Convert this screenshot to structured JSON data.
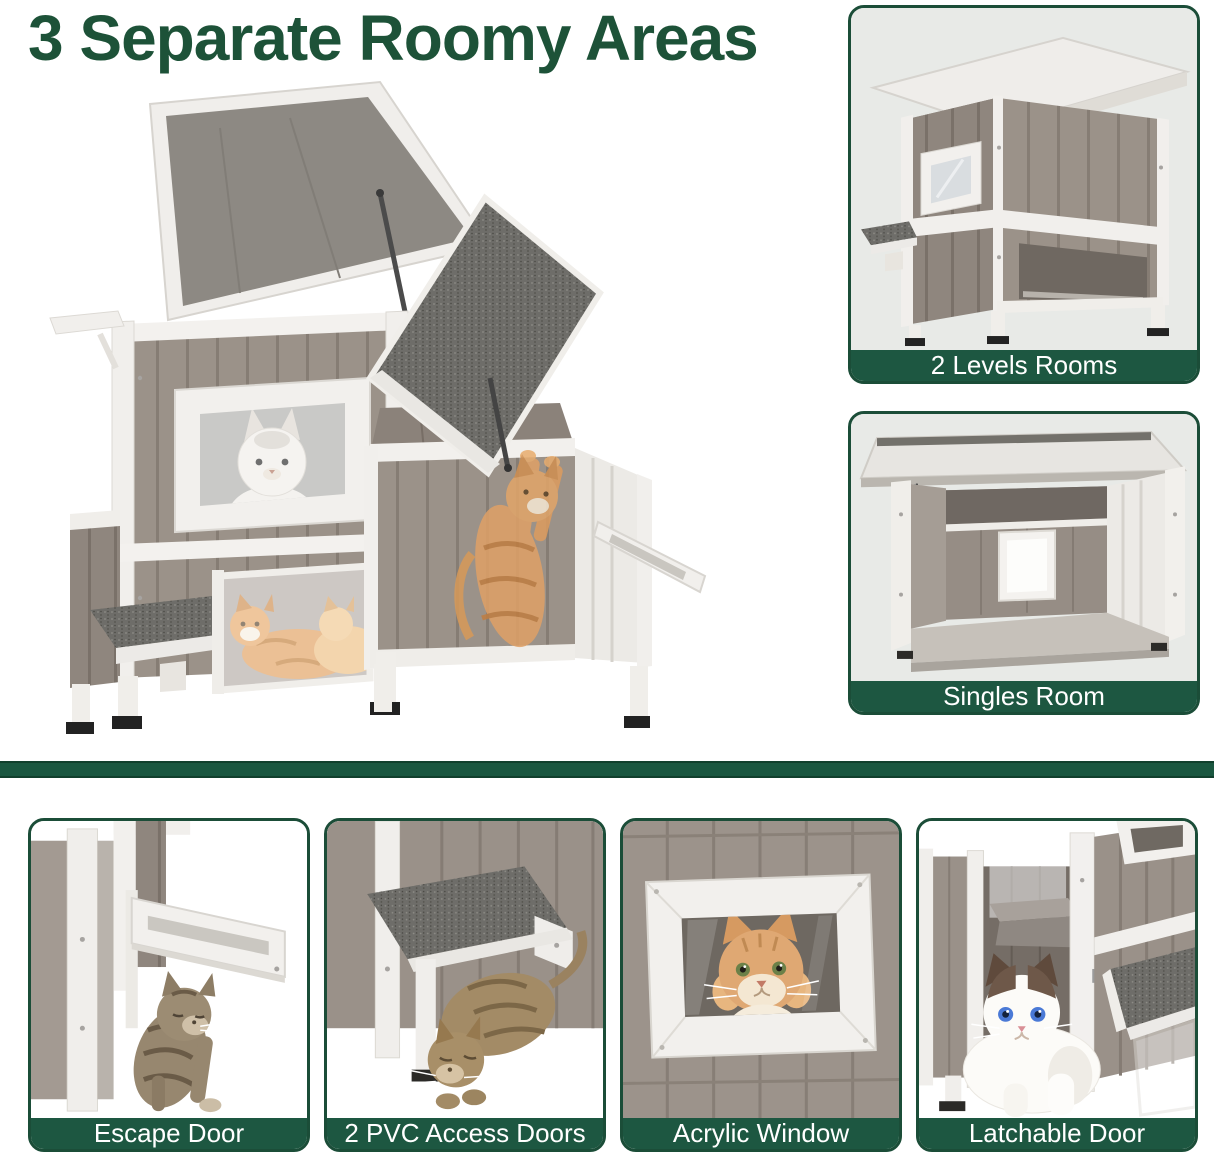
{
  "title": "3 Separate Roomy Areas",
  "colors": {
    "title_green": "#1d5238",
    "card_border": "#1b4d38",
    "label_bar": "#1d5741",
    "divider": "#1a5740",
    "card_bg": "#e9ebe8"
  },
  "right_cards": [
    {
      "label": "2 Levels Rooms"
    },
    {
      "label": "Singles Room"
    }
  ],
  "bottom_cards": [
    {
      "label": "Escape Door"
    },
    {
      "label": "2 PVC Access Doors"
    },
    {
      "label": "Acrylic Window"
    },
    {
      "label": "Latchable Door"
    }
  ]
}
